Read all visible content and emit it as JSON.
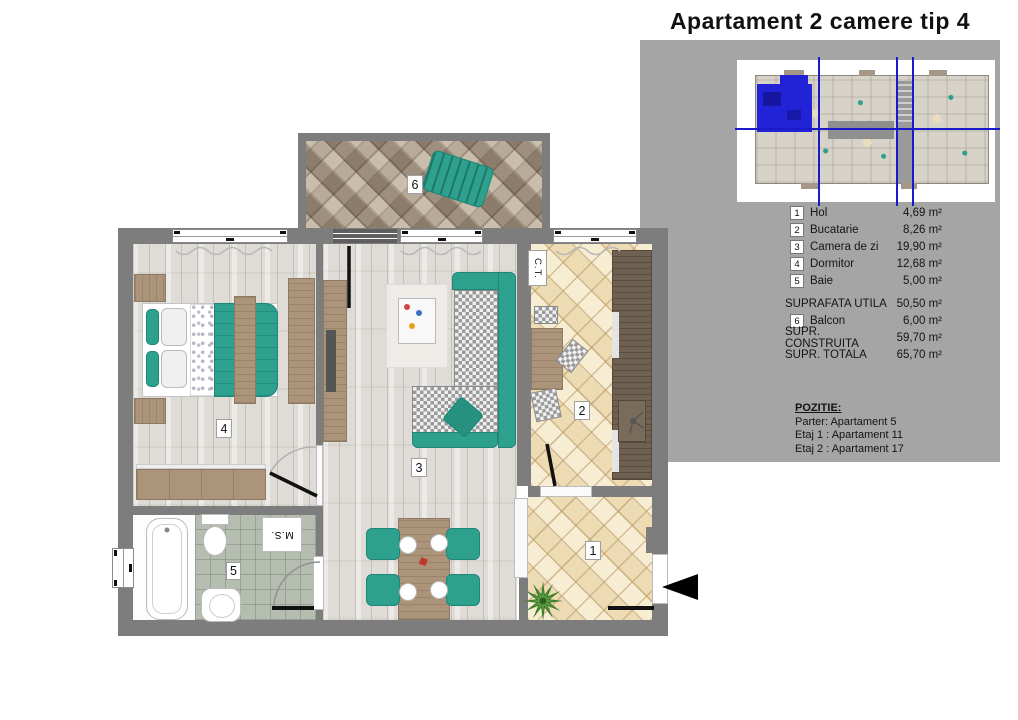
{
  "title": "Apartament 2 camere tip 4",
  "colors": {
    "accent_teal": "#2da08e",
    "highlight_blue": "#2222d6",
    "axis_blue": "#1a1ac8",
    "panel_gray": "#a5a5a5",
    "wall_gray": "#7d7d7d"
  },
  "plan": {
    "labels": {
      "hol": "1",
      "bucatarie": "2",
      "camera_de_zi": "3",
      "dormitor": "4",
      "baie": "5",
      "balcon": "6"
    },
    "annotations": {
      "centrala_termica": "C.T.",
      "masina_spalat": "M.S."
    }
  },
  "legend": {
    "rooms": [
      {
        "num": "1",
        "name": "Hol",
        "area": "4,69 m²"
      },
      {
        "num": "2",
        "name": "Bucatarie",
        "area": "8,26 m²"
      },
      {
        "num": "3",
        "name": "Camera de zi",
        "area": "19,90 m²"
      },
      {
        "num": "4",
        "name": "Dormitor",
        "area": "12,68 m²"
      },
      {
        "num": "5",
        "name": "Baie",
        "area": "5,00 m²"
      }
    ],
    "suprafata_utila": {
      "label": "SUPRAFATA UTILA",
      "area": "50,50 m²"
    },
    "balcony_row": {
      "num": "6",
      "name": "Balcon",
      "area": "6,00 m²"
    },
    "supr_construita": {
      "label": "SUPR. CONSTRUITA",
      "area": "59,70 m²"
    },
    "supr_totala": {
      "label": "SUPR. TOTALA",
      "area": "65,70 m²"
    }
  },
  "pozitie": {
    "heading": "POZITIE:",
    "lines": [
      "Parter:  Apartament 5",
      "Etaj 1 : Apartament 11",
      "Etaj 2 : Apartament 17"
    ]
  }
}
